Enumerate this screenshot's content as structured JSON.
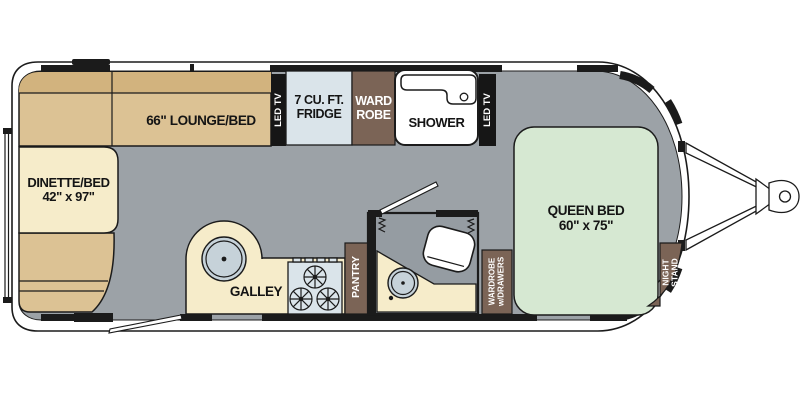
{
  "colors": {
    "line": "#1b1b1b",
    "floor": "#9ca2a7",
    "seat_tan": "#dcc294",
    "seat_tan_dark": "#d2b37e",
    "cream": "#f6ecca",
    "appliance_blue": "#dae4ea",
    "sink_gray": "#c6d2d9",
    "cabinet_brown": "#7b6456",
    "bed_green": "#d6e8d2",
    "bathroom_gray": "#959ca2",
    "tv_black": "#161616"
  },
  "areas": {
    "dinette": {
      "label": "DINETTE/BED",
      "size": "42\" x 97\""
    },
    "lounge": {
      "label": "66\" LOUNGE/BED"
    },
    "led_tv_left": {
      "label": "LED TV"
    },
    "fridge": {
      "line1": "7 CU. FT.",
      "line2": "FRIDGE"
    },
    "wardrobe_front": {
      "line1": "WARD",
      "line2": "ROBE"
    },
    "shower": {
      "label": "SHOWER"
    },
    "led_tv_right": {
      "label": "LED TV"
    },
    "queen_bed": {
      "label": "QUEEN BED",
      "size": "60\" x 75\""
    },
    "night_stand": {
      "line1": "NIGHT",
      "line2": "STAND"
    },
    "galley": {
      "label": "GALLEY"
    },
    "pantry": {
      "label": "PANTRY"
    },
    "wardrobe_drawers": {
      "line1": "WARDROBE",
      "line2": "w/DRAWERS"
    }
  }
}
